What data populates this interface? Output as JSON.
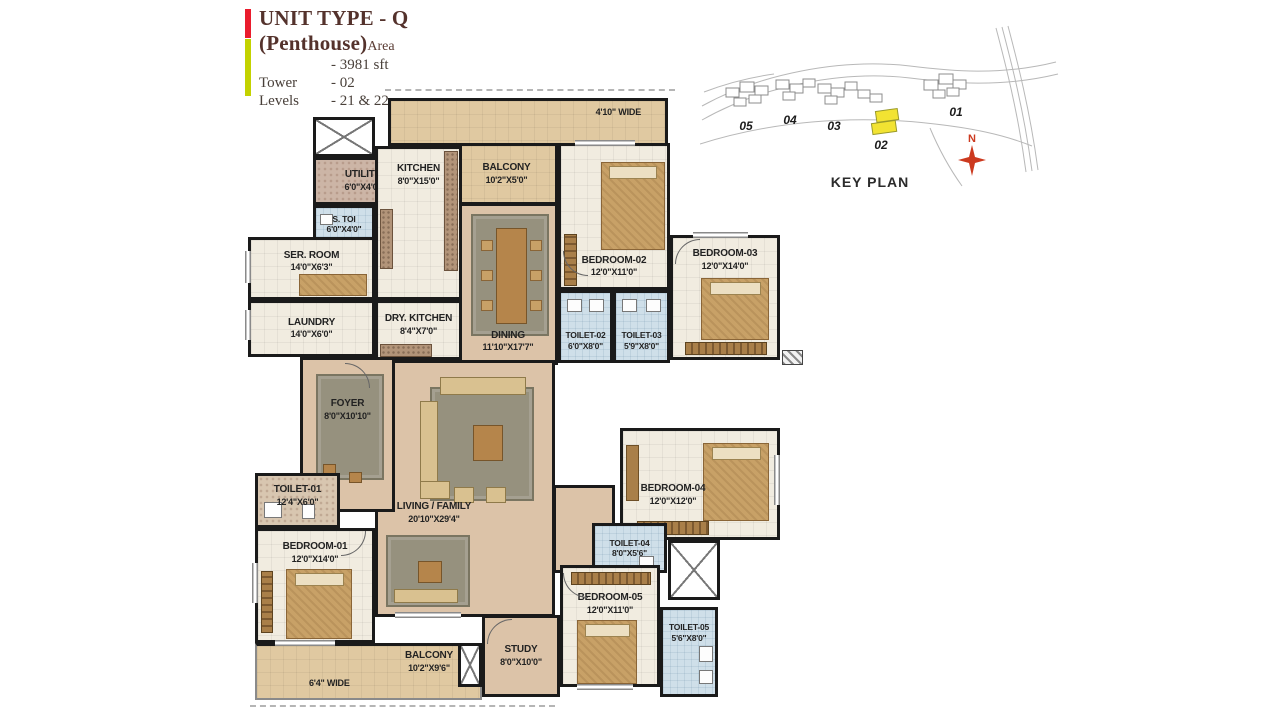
{
  "header": {
    "title": "UNIT TYPE - Q (Penthouse)",
    "title_suffix": "Area",
    "specs": [
      {
        "label": "",
        "value": "- 3981 sft"
      },
      {
        "label": "Tower",
        "value": "- 02"
      },
      {
        "label": "Levels",
        "value": "- 21 & 22"
      }
    ]
  },
  "key_plan": {
    "label": "KEY PLAN",
    "north": "N",
    "tower_labels": [
      "05",
      "04",
      "03",
      "02",
      "01"
    ],
    "highlighted_tower": "02",
    "highlight_color": "#f2e332"
  },
  "rooms": {
    "top_strip": {
      "dim": "4'10\" WIDE"
    },
    "balcony_top": {
      "name": "BALCONY",
      "dim": "10'2\"X5'0\""
    },
    "utility": {
      "name": "UTILITY",
      "dim": "6'0\"X4'0\""
    },
    "kitchen": {
      "name": "KITCHEN",
      "dim": "8'0\"X15'0\""
    },
    "s_toi": {
      "name": "S. TOI",
      "dim": "6'0\"X4'0\""
    },
    "ser_room": {
      "name": "SER. ROOM",
      "dim": "14'0\"X6'3\""
    },
    "laundry": {
      "name": "LAUNDRY",
      "dim": "14'0\"X6'0\""
    },
    "dry_kitchen": {
      "name": "DRY. KITCHEN",
      "dim": "8'4\"X7'0\""
    },
    "dining": {
      "name": "DINING",
      "dim": "11'10\"X17'7\""
    },
    "bedroom_02": {
      "name": "BEDROOM-02",
      "dim": "12'0\"X11'0\""
    },
    "bedroom_03": {
      "name": "BEDROOM-03",
      "dim": "12'0\"X14'0\""
    },
    "toilet_02": {
      "name": "TOILET-02",
      "dim": "6'0\"X8'0\""
    },
    "toilet_03": {
      "name": "TOILET-03",
      "dim": "5'9\"X8'0\""
    },
    "foyer": {
      "name": "FOYER",
      "dim": "8'0\"X10'10\""
    },
    "living": {
      "name": "LIVING / FAMILY",
      "dim": "20'10\"X29'4\""
    },
    "toilet_01": {
      "name": "TOILET-01",
      "dim": "12'4\"X6'0\""
    },
    "bedroom_01": {
      "name": "BEDROOM-01",
      "dim": "12'0\"X14'0\""
    },
    "balcony_bottom": {
      "name": "BALCONY",
      "dim": "10'2\"X9'6\"",
      "width_note": "6'4\" WIDE"
    },
    "study": {
      "name": "STUDY",
      "dim": "8'0\"X10'0\""
    },
    "bedroom_04": {
      "name": "BEDROOM-04",
      "dim": "12'0\"X12'0\""
    },
    "toilet_04": {
      "name": "TOILET-04",
      "dim": "8'0\"X5'6\""
    },
    "bedroom_05": {
      "name": "BEDROOM-05",
      "dim": "12'0\"X11'0\""
    },
    "toilet_05": {
      "name": "TOILET-05",
      "dim": "5'6\"X8'0\""
    }
  },
  "colors": {
    "wall": "#1a1a1a",
    "room_floor": "#f1ece0",
    "balcony_floor": "#e0c9a1",
    "living_floor": "#dcc3a8",
    "toilet_floor": "#cfdfe9",
    "accent_red": "#ea1c2d",
    "accent_green": "#c3d200",
    "title_text": "#54322c"
  }
}
